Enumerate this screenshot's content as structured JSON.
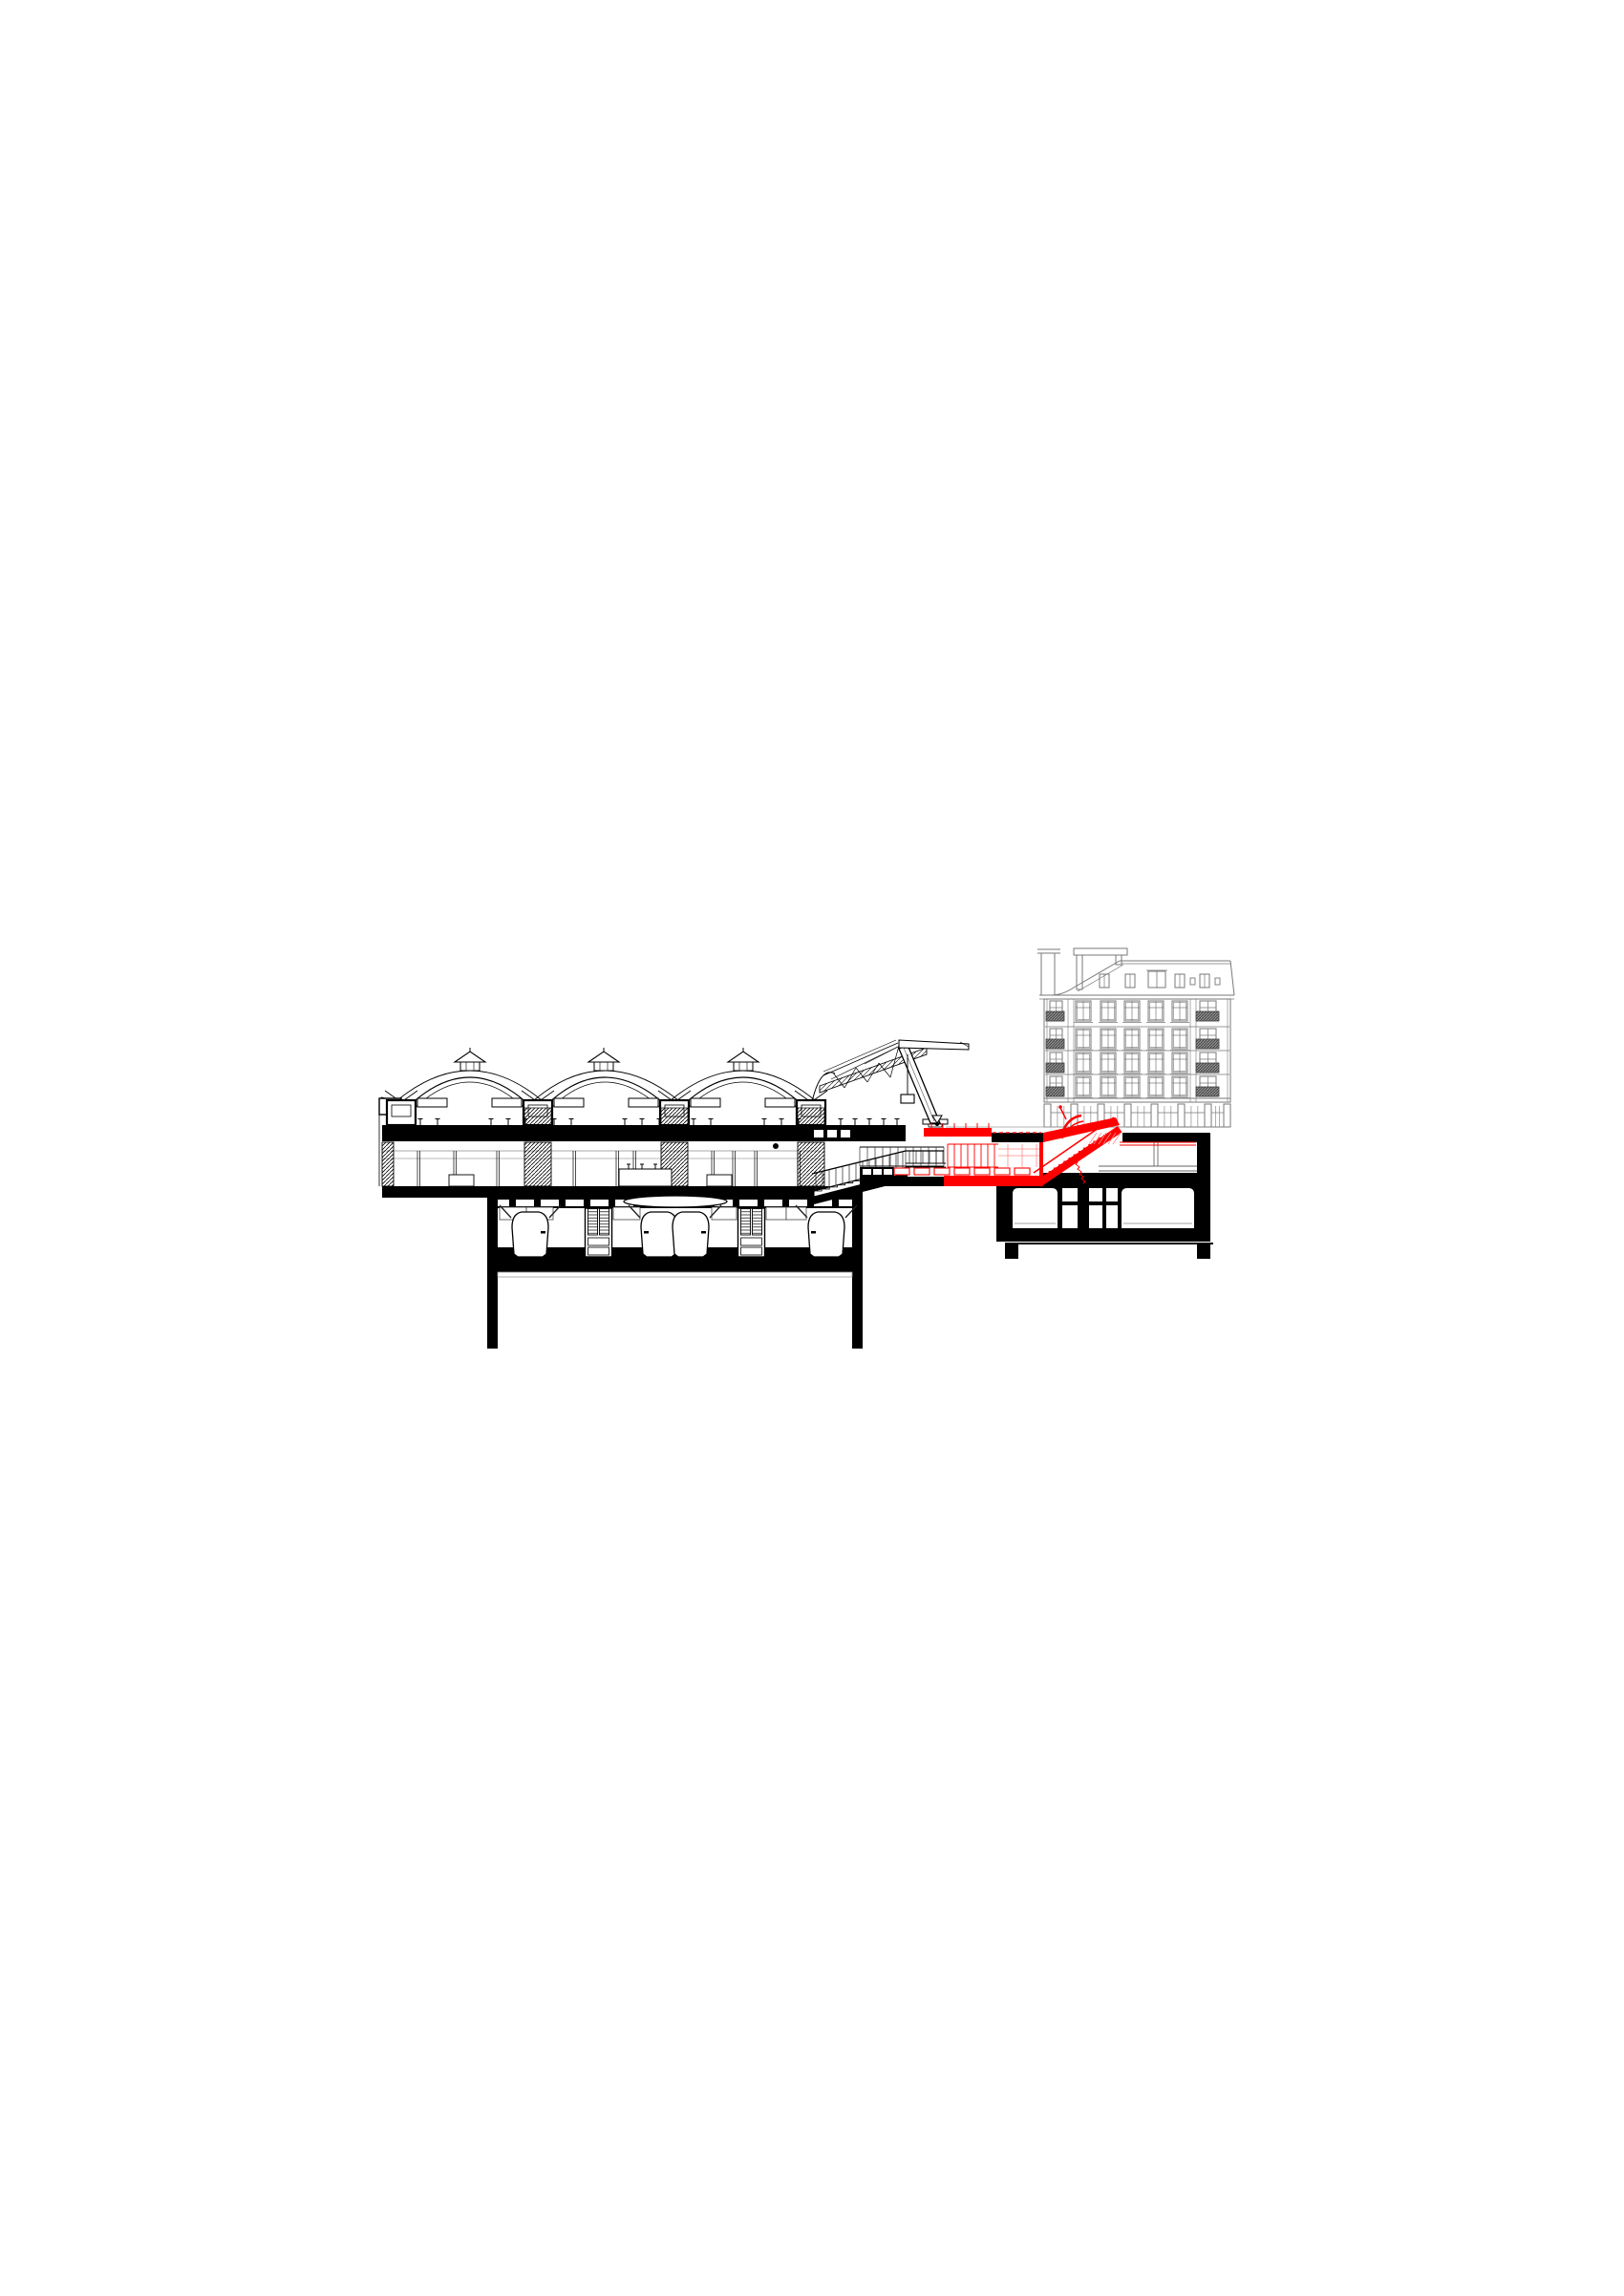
{
  "page": {
    "background": "#ffffff"
  },
  "colors": {
    "ink": "#000000",
    "highlight_red": "#ff0000",
    "highlight_red_light": "#ff8a8a",
    "facade_gray": "#787878",
    "light_gray": "#9a9a9a",
    "balcony_dark": "#3f3f3f",
    "paper": "#ffffff"
  },
  "drawing": {
    "type": "architectural-section",
    "station_hall": {
      "vault_bays": 3,
      "roof_lanterns": 3,
      "vault_capitals": 4,
      "escalator_shafts": 3,
      "mezzanine_columns": 10
    },
    "tunnel_level": {
      "trains": 4,
      "platform_cores": 2,
      "has_oval_duct": true
    },
    "street_canopy": {
      "has_inclined_mast": true,
      "has_hanging_sign": true
    },
    "new_intervention": {
      "highlight_color": "#ff0000",
      "elements": [
        "street-entrance-canopy",
        "underground-concourse-glazing",
        "concourse-floor-joists",
        "escalator-link-to-building",
        "escalator-steps"
      ],
      "glazing_mullions": 8,
      "floor_joists": 8
    },
    "building": {
      "floors_above_ground": 4,
      "window_columns": 5,
      "balcony_columns": 2,
      "dormers": 5,
      "small_dormers": 2,
      "has_mansard_roof": true,
      "chimneys": 2,
      "storefront_bays": 7,
      "basement_small_cells": 6,
      "basement_large_rooms": 2,
      "foundation_legs": 2
    }
  }
}
